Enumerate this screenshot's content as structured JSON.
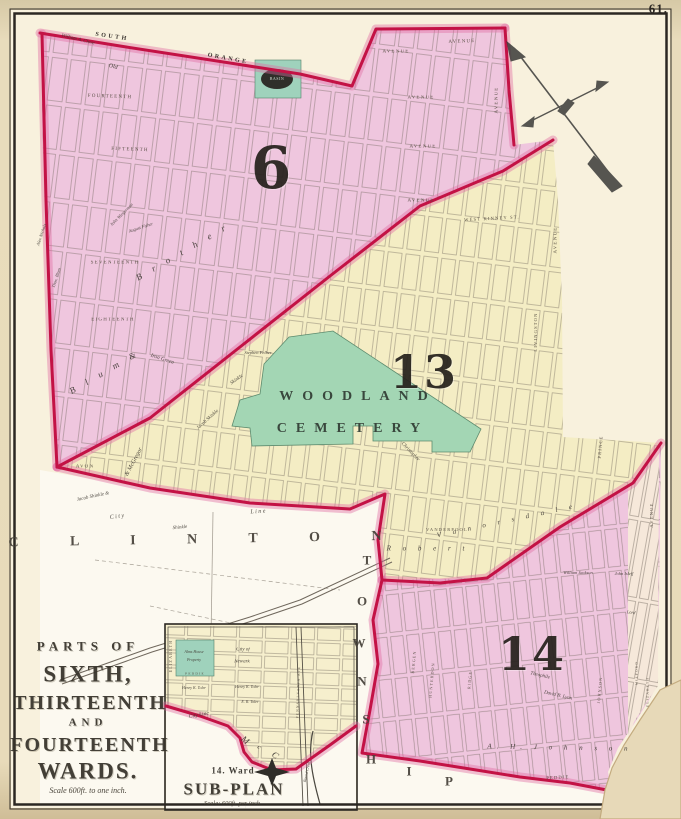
{
  "page_number": "61.",
  "map_title": {
    "line1": "PARTS OF",
    "line2": "SIXTH,",
    "line3": "THIRTEENTH",
    "line4": "AND",
    "line5": "FOURTEENTH",
    "line6": "WARDS.",
    "scale": "Scale 600ft. to one inch."
  },
  "subplan": {
    "subtitle": "14. Ward",
    "title": "SUB-PLAN",
    "scale": "Scale: 600ft. per inch"
  },
  "wards": [
    "6",
    "13",
    "14"
  ],
  "colors": {
    "ward_pink": "#efc6de",
    "ward_yellow": "#f4edc4",
    "cemetery_green": "#a3d6b4",
    "inset_green": "#9fd2bc",
    "boundary_red": "#c31245",
    "map_cream": "#f8f1dd",
    "pale_strip": "#f6e8da"
  },
  "labels": [
    {
      "t": "6",
      "x": 272,
      "y": 168,
      "s": 58,
      "r": 0,
      "c": "ward",
      "n": "ward-6-numeral"
    },
    {
      "t": "13",
      "x": 424,
      "y": 372,
      "s": 46,
      "r": 0,
      "c": "ward",
      "n": "ward-13-numeral"
    },
    {
      "t": "14",
      "x": 532,
      "y": 654,
      "s": 46,
      "r": 0,
      "c": "ward",
      "n": "ward-14-numeral"
    },
    {
      "t": "SOUTH",
      "x": 112,
      "y": 37,
      "s": 6,
      "r": 8,
      "c": "road"
    },
    {
      "t": "ORANGE",
      "x": 228,
      "y": 59,
      "s": 6,
      "r": 10,
      "c": "road"
    },
    {
      "t": "William A. Clove",
      "x": 78,
      "y": 40,
      "s": 5,
      "r": 14,
      "c": "curs"
    },
    {
      "t": "Old",
      "x": 113,
      "y": 67,
      "s": 6,
      "r": 14,
      "c": "curs"
    },
    {
      "t": "FOURTEENTH",
      "x": 110,
      "y": 97,
      "s": 5,
      "r": 2,
      "c": "street"
    },
    {
      "t": "FIFTEENTH",
      "x": 130,
      "y": 150,
      "s": 5,
      "r": 2,
      "c": "street"
    },
    {
      "t": "AVENUE",
      "x": 462,
      "y": 42,
      "s": 5,
      "r": -2,
      "c": "street"
    },
    {
      "t": "AVENUE",
      "x": 396,
      "y": 52,
      "s": 5,
      "r": 0,
      "c": "street"
    },
    {
      "t": "AVENUE",
      "x": 421,
      "y": 98,
      "s": 5,
      "r": 0,
      "c": "street"
    },
    {
      "t": "AVENUE",
      "x": 423,
      "y": 147,
      "s": 5,
      "r": 0,
      "c": "street"
    },
    {
      "t": "AVENUE",
      "x": 421,
      "y": 201,
      "s": 5,
      "r": 0,
      "c": "street"
    },
    {
      "t": "AVENUE",
      "x": 497,
      "y": 100,
      "s": 5,
      "r": -90,
      "c": "street"
    },
    {
      "t": "SEVENTEENTH",
      "x": 115,
      "y": 263,
      "s": 5,
      "r": 0,
      "c": "street"
    },
    {
      "t": "EIGHTEENTH",
      "x": 113,
      "y": 320,
      "s": 5,
      "r": 0,
      "c": "street"
    },
    {
      "t": "B r o t h e r",
      "x": 183,
      "y": 252,
      "s": 9,
      "r": -30,
      "c": "spread"
    },
    {
      "t": "B l u m &",
      "x": 105,
      "y": 372,
      "s": 9,
      "r": -30,
      "c": "spread"
    },
    {
      "t": "Iron Green",
      "x": 162,
      "y": 360,
      "s": 5.5,
      "r": 18,
      "c": "curs"
    },
    {
      "t": "Alex Nichols",
      "x": 42,
      "y": 235,
      "s": 4.5,
      "r": -72,
      "c": "curs"
    },
    {
      "t": "Thos. Blum",
      "x": 57,
      "y": 278,
      "s": 4.5,
      "r": -72,
      "c": "curs"
    },
    {
      "t": "John Wiegerman",
      "x": 122,
      "y": 215,
      "s": 4.5,
      "r": -45,
      "c": "curs"
    },
    {
      "t": "August Fisher",
      "x": 141,
      "y": 228,
      "s": 4.5,
      "r": -18,
      "c": "curs"
    },
    {
      "t": "Jacob Skinkle",
      "x": 208,
      "y": 420,
      "s": 5,
      "r": -42,
      "c": "curs"
    },
    {
      "t": "& McGregor",
      "x": 134,
      "y": 462,
      "s": 6,
      "r": -62,
      "c": "curs"
    },
    {
      "t": "AVON",
      "x": 85,
      "y": 467,
      "s": 5,
      "r": 0,
      "c": "street"
    },
    {
      "t": "Jacob Shinkle &",
      "x": 93,
      "y": 497,
      "s": 5,
      "r": -12,
      "c": "curs"
    },
    {
      "t": "C i t y",
      "x": 117,
      "y": 517,
      "s": 6,
      "r": -8,
      "c": "curs"
    },
    {
      "t": "L i n e",
      "x": 258,
      "y": 512,
      "s": 6,
      "r": -4,
      "c": "curs"
    },
    {
      "t": "C L I N T O N",
      "x": 207,
      "y": 540,
      "s": 14,
      "r": -1,
      "c": "bigspread",
      "n": "clinton-township-label"
    },
    {
      "t": "Shinkle",
      "x": 180,
      "y": 528,
      "s": 5,
      "r": -5,
      "c": "curs"
    },
    {
      "t": "T",
      "x": 367,
      "y": 560,
      "s": 13,
      "r": 0,
      "c": "twp",
      "n": "township-letter"
    },
    {
      "t": "O",
      "x": 362,
      "y": 601,
      "s": 13,
      "r": 0,
      "c": "twp",
      "n": "township-letter"
    },
    {
      "t": "W",
      "x": 359,
      "y": 643,
      "s": 13,
      "r": 0,
      "c": "twp",
      "n": "township-letter"
    },
    {
      "t": "N",
      "x": 362,
      "y": 681,
      "s": 13,
      "r": 0,
      "c": "twp",
      "n": "township-letter"
    },
    {
      "t": "S",
      "x": 366,
      "y": 719,
      "s": 13,
      "r": 0,
      "c": "twp",
      "n": "township-letter"
    },
    {
      "t": "H",
      "x": 371,
      "y": 759,
      "s": 13,
      "r": 0,
      "c": "twp",
      "n": "township-letter"
    },
    {
      "t": "I",
      "x": 409,
      "y": 771,
      "s": 13,
      "r": 0,
      "c": "twp",
      "n": "township-letter"
    },
    {
      "t": "P",
      "x": 449,
      "y": 781,
      "s": 13,
      "r": 0,
      "c": "twp",
      "n": "township-letter"
    },
    {
      "t": "WOODLAND",
      "x": 358,
      "y": 397,
      "s": 14,
      "r": 0,
      "c": "cem",
      "n": "woodland-cemetery-label"
    },
    {
      "t": "CEMETERY",
      "x": 353,
      "y": 429,
      "s": 14,
      "r": 0,
      "c": "cem",
      "n": "woodland-cemetery-label"
    },
    {
      "t": "Stephen Felber",
      "x": 258,
      "y": 353,
      "s": 4.5,
      "r": 0,
      "c": "curs"
    },
    {
      "t": "Skinkle",
      "x": 237,
      "y": 380,
      "s": 5,
      "r": -35,
      "c": "curs"
    },
    {
      "t": "WEST KINNEY ST.",
      "x": 492,
      "y": 219,
      "s": 4.5,
      "r": -3,
      "c": "street"
    },
    {
      "t": "AVENUE",
      "x": 556,
      "y": 240,
      "s": 5,
      "r": -90,
      "c": "street"
    },
    {
      "t": "LIVINGSTON",
      "x": 536,
      "y": 332,
      "s": 4.5,
      "r": -90,
      "c": "street"
    },
    {
      "t": "PRINCE",
      "x": 601,
      "y": 447,
      "s": 4.5,
      "r": -85,
      "c": "street"
    },
    {
      "t": "Christopher",
      "x": 410,
      "y": 452,
      "s": 5,
      "r": 46,
      "c": "curs"
    },
    {
      "t": "R o b e r t",
      "x": 428,
      "y": 549,
      "s": 7,
      "r": 0,
      "c": "spread"
    },
    {
      "t": "V a n o r s d a l e",
      "x": 507,
      "y": 521,
      "s": 7,
      "r": -12,
      "c": "spread"
    },
    {
      "t": "VANDERPOOL",
      "x": 447,
      "y": 530,
      "s": 4.5,
      "r": 0,
      "c": "street"
    },
    {
      "t": "William Jackson",
      "x": 578,
      "y": 573,
      "s": 4.5,
      "r": 0,
      "c": "curs"
    },
    {
      "t": "John Isleff",
      "x": 624,
      "y": 574,
      "s": 4.5,
      "r": 0,
      "c": "curs"
    },
    {
      "t": "Lord",
      "x": 631,
      "y": 613,
      "s": 4.5,
      "r": 6,
      "c": "curs"
    },
    {
      "t": "Theophile",
      "x": 540,
      "y": 676,
      "s": 5,
      "r": 13,
      "c": "curs"
    },
    {
      "t": "David B. Lyon",
      "x": 558,
      "y": 696,
      "s": 5,
      "r": 13,
      "c": "curs"
    },
    {
      "t": "A.  H.  J o h n s o n",
      "x": 560,
      "y": 748,
      "s": 7,
      "r": 1,
      "c": "spread"
    },
    {
      "t": "PEDDIE",
      "x": 558,
      "y": 778,
      "s": 4.5,
      "r": -3,
      "c": "street"
    },
    {
      "t": "BERGEN",
      "x": 414,
      "y": 662,
      "s": 4,
      "r": -85,
      "c": "street"
    },
    {
      "t": "HUNTERDON",
      "x": 432,
      "y": 680,
      "s": 4,
      "r": -85,
      "c": "street"
    },
    {
      "t": "RIDGE",
      "x": 470,
      "y": 680,
      "s": 4,
      "r": -85,
      "c": "street"
    },
    {
      "t": "JOHNSON",
      "x": 600,
      "y": 690,
      "s": 4,
      "r": -85,
      "c": "street"
    },
    {
      "t": "MILFORD",
      "x": 637,
      "y": 673,
      "s": 3.5,
      "r": -90,
      "c": "street"
    },
    {
      "t": "ELIZABETH",
      "x": 648,
      "y": 692,
      "s": 3.5,
      "r": -90,
      "c": "street"
    },
    {
      "t": "AVENUE",
      "x": 652,
      "y": 515,
      "s": 4.5,
      "r": -90,
      "c": "street"
    },
    {
      "t": "BASIN",
      "x": 277,
      "y": 79,
      "s": 4,
      "r": 0,
      "c": "basin",
      "n": "basin-label"
    },
    {
      "t": "PARTS OF",
      "x": 88,
      "y": 646,
      "s": 13,
      "r": 0,
      "c": "titlesp",
      "n": "map-title-line"
    },
    {
      "t": "SIXTH,",
      "x": 88,
      "y": 674,
      "s": 23,
      "r": 0,
      "c": "title",
      "n": "map-title-line"
    },
    {
      "t": "THIRTEENTH",
      "x": 90,
      "y": 703,
      "s": 20,
      "r": 0,
      "c": "title",
      "n": "map-title-line"
    },
    {
      "t": "AND",
      "x": 88,
      "y": 723,
      "s": 11,
      "r": 0,
      "c": "titlesp",
      "n": "map-title-line"
    },
    {
      "t": "FOURTEENTH",
      "x": 90,
      "y": 745,
      "s": 20,
      "r": 0,
      "c": "title",
      "n": "map-title-line"
    },
    {
      "t": "WARDS.",
      "x": 88,
      "y": 771,
      "s": 23,
      "r": 0,
      "c": "title",
      "n": "map-title-line"
    },
    {
      "t": "Scale 600ft. to one inch.",
      "x": 88,
      "y": 791,
      "s": 8,
      "r": 0,
      "c": "scale",
      "n": "map-scale-note"
    },
    {
      "t": "ELIZABETH",
      "x": 171,
      "y": 656,
      "s": 4,
      "r": -90,
      "c": "street"
    },
    {
      "t": "Alms House",
      "x": 194,
      "y": 652,
      "s": 4,
      "r": 0,
      "c": "curs"
    },
    {
      "t": "Property",
      "x": 194,
      "y": 660,
      "s": 4,
      "r": 0,
      "c": "curs"
    },
    {
      "t": "City of",
      "x": 243,
      "y": 650,
      "s": 5,
      "r": 0,
      "c": "curs"
    },
    {
      "t": "Newark",
      "x": 242,
      "y": 662,
      "s": 5,
      "r": 0,
      "c": "curs"
    },
    {
      "t": "PEDDIE",
      "x": 195,
      "y": 674,
      "s": 3.5,
      "r": 0,
      "c": "street"
    },
    {
      "t": "Henry K. Toler",
      "x": 194,
      "y": 688,
      "s": 4,
      "r": 0,
      "c": "curs"
    },
    {
      "t": "Henry K. Toler",
      "x": 247,
      "y": 687,
      "s": 4,
      "r": 0,
      "c": "curs"
    },
    {
      "t": "E. R. Toler",
      "x": 250,
      "y": 702,
      "s": 4,
      "r": 0,
      "c": "curs"
    },
    {
      "t": "City Line",
      "x": 199,
      "y": 716,
      "s": 5.5,
      "r": -10,
      "c": "curs"
    },
    {
      "t": "M",
      "x": 247,
      "y": 742,
      "s": 9,
      "r": 40,
      "c": "spread"
    },
    {
      "t": "c",
      "x": 261,
      "y": 749,
      "s": 7,
      "r": 40,
      "c": "spread"
    },
    {
      "t": "C",
      "x": 277,
      "y": 757,
      "s": 9,
      "r": 40,
      "c": "spread"
    },
    {
      "t": "PENNSYLVANIA AVE",
      "x": 299,
      "y": 692,
      "s": 3.5,
      "r": -88,
      "c": "street"
    },
    {
      "t": "Bound Creek",
      "x": 307,
      "y": 772,
      "s": 4,
      "r": -78,
      "c": "curs"
    },
    {
      "t": "14. Ward",
      "x": 233,
      "y": 771,
      "s": 9,
      "r": 0,
      "c": "subttl",
      "n": "subplan-subtitle"
    },
    {
      "t": "SUB-PLAN",
      "x": 234,
      "y": 789,
      "s": 17,
      "r": 0,
      "c": "title",
      "n": "subplan-title"
    },
    {
      "t": "Scale: 600ft. per inch",
      "x": 232,
      "y": 804,
      "s": 6.5,
      "r": 0,
      "c": "scale",
      "n": "subplan-scale-note"
    }
  ]
}
